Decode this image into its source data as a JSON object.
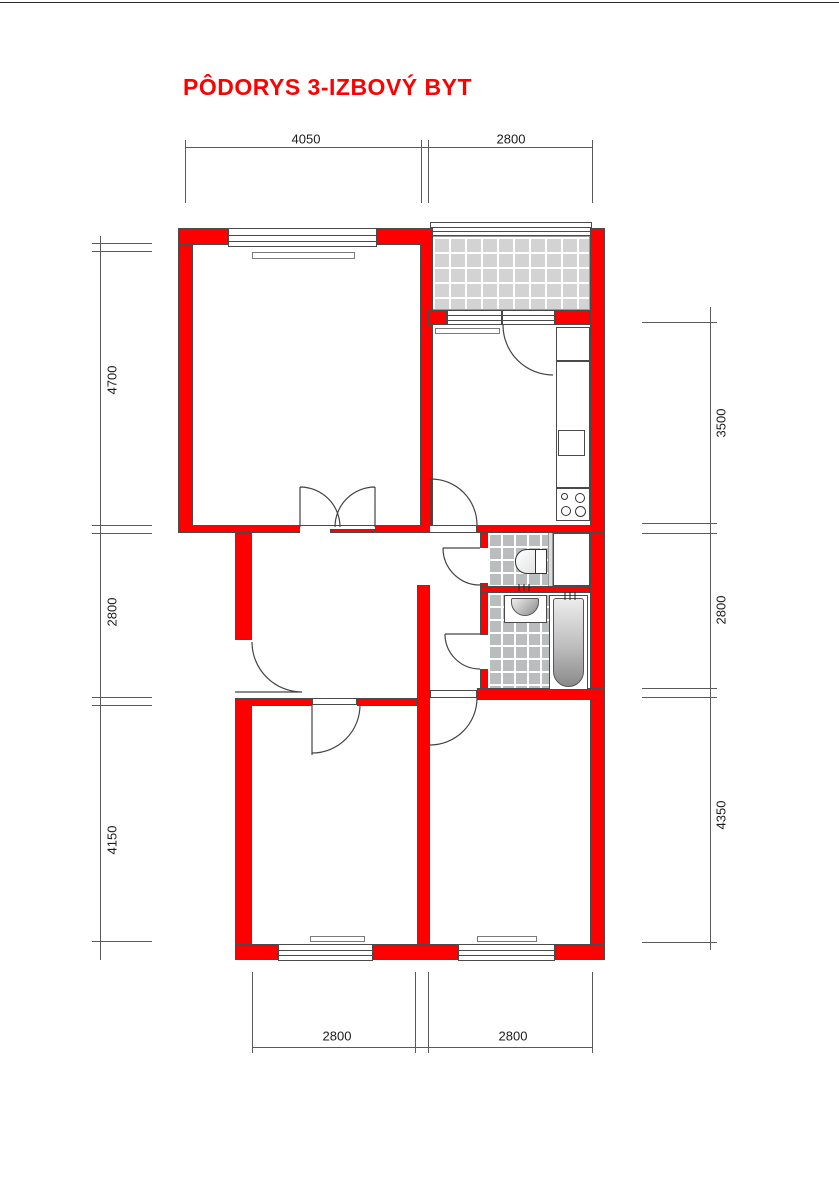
{
  "title": {
    "text": "PÔDORYS 3-IZBOVÝ BYT"
  },
  "dimensions": {
    "top": [
      {
        "value": "4050"
      },
      {
        "value": "2800"
      }
    ],
    "left": [
      {
        "value": "4700"
      },
      {
        "value": "2800"
      },
      {
        "value": "4150"
      }
    ],
    "right": [
      {
        "value": "3500"
      },
      {
        "value": "2800"
      },
      {
        "value": "4350"
      }
    ],
    "bottom": [
      {
        "value": "2800"
      },
      {
        "value": "2800"
      }
    ]
  },
  "colors": {
    "title": "#ff0000",
    "wall": "#ff0000",
    "outline": "#4a4a4a",
    "dim": "#5a5a5a",
    "tile_balcony": "#d3d3d3",
    "tile_bath": "#b9bdbe"
  }
}
